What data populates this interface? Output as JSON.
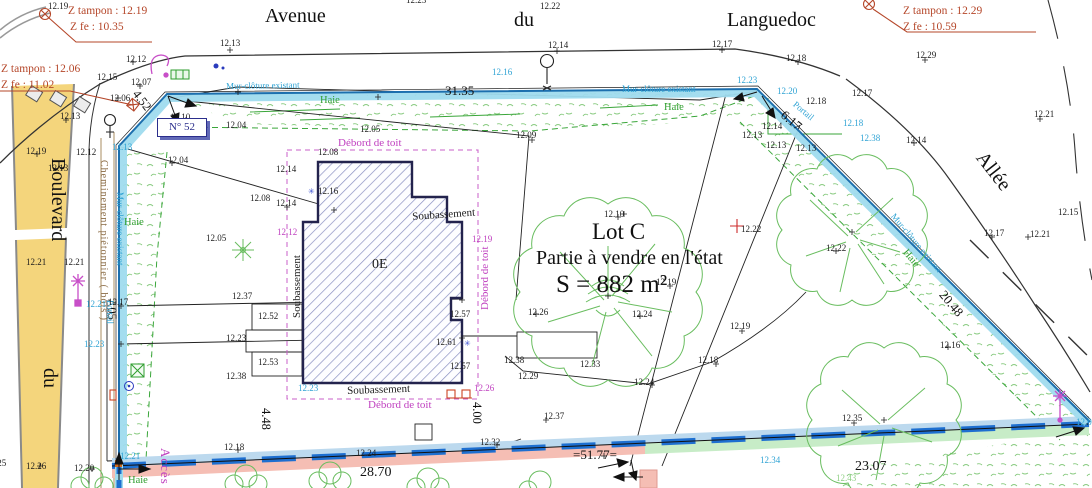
{
  "plate": {
    "text": "N° 52"
  },
  "colors": {
    "wall_band": "#9fdbee",
    "wall_line": "#1c6fae",
    "boundary_dash": "#1e6fd0",
    "hedge_green": "#2f9e2f",
    "speckle": "#86c97d",
    "magenta": "#bf3fbf",
    "red_note": "#b5472a",
    "cyan_label": "#2fa3d4",
    "road_yellow": "#f4d57c",
    "pink_band": "#f5beb4",
    "green_band": "#c7ecc7",
    "blue_band": "#bcd9ee",
    "hatch": "#8a90c2"
  },
  "labels": [
    {
      "t": "Avenue",
      "x": 265,
      "y": 6,
      "c": "s"
    },
    {
      "t": "du",
      "x": 514,
      "y": 10,
      "c": "s"
    },
    {
      "t": "Languedoc",
      "x": 727,
      "y": 10,
      "c": "s"
    },
    {
      "t": "Boulevard",
      "x": 68,
      "y": 158,
      "c": "s",
      "r": 90
    },
    {
      "t": "du",
      "x": 60,
      "y": 368,
      "c": "s",
      "r": 90
    },
    {
      "t": "Allée",
      "x": 988,
      "y": 148,
      "c": "s",
      "r": 52
    },
    {
      "t": "Accès à",
      "x": 172,
      "y": 448,
      "c": "ma",
      "r": 90
    },
    {
      "t": "Z tampon : 12.19",
      "x": 68,
      "y": 6,
      "c": "r"
    },
    {
      "t": "Z fe : 10.35",
      "x": 70,
      "y": 22,
      "c": "r"
    },
    {
      "t": "Z tampon : 12.06",
      "x": 1,
      "y": 64,
      "c": "r"
    },
    {
      "t": "Z fe : 11.02",
      "x": 1,
      "y": 80,
      "c": "r"
    },
    {
      "t": "Z tampon : 12.29",
      "x": 903,
      "y": 6,
      "c": "r"
    },
    {
      "t": "Z fe : 10.59",
      "x": 903,
      "y": 22,
      "c": "r"
    },
    {
      "t": "31.35",
      "x": 445,
      "y": 84,
      "c": "d",
      "s": 13
    },
    {
      "t": "4.52",
      "x": 140,
      "y": 88,
      "c": "d",
      "r": 52
    },
    {
      "t": "6.17",
      "x": 787,
      "y": 108,
      "c": "d",
      "r": 40,
      "s": 13
    },
    {
      "t": "20.48",
      "x": 947,
      "y": 288,
      "c": "d",
      "r": 50,
      "s": 13
    },
    {
      "t": "7.05",
      "x": 118,
      "y": 298,
      "c": "d",
      "r": 90
    },
    {
      "t": "4.48",
      "x": 272,
      "y": 408,
      "c": "d",
      "r": 90
    },
    {
      "t": "4.00",
      "x": 483,
      "y": 402,
      "c": "d",
      "r": 90
    },
    {
      "t": "28.70",
      "x": 360,
      "y": 466,
      "c": "d",
      "s": 14
    },
    {
      "t": "=51.77=",
      "x": 573,
      "y": 448,
      "c": "d",
      "s": 13
    },
    {
      "t": "23.07",
      "x": 855,
      "y": 460,
      "c": "d",
      "s": 14
    },
    {
      "t": "Lot C",
      "x": 592,
      "y": 220,
      "c": "l1"
    },
    {
      "t": "Partie à vendre en l'état",
      "x": 536,
      "y": 248,
      "c": "l2"
    },
    {
      "t": "S = 882 m²",
      "x": 556,
      "y": 272,
      "c": "l3"
    },
    {
      "t": "0E",
      "x": 372,
      "y": 258,
      "c": "e",
      "s": 14
    },
    {
      "t": "Soubassement",
      "x": 292,
      "y": 318,
      "c": "e",
      "s": 11,
      "r": -90
    },
    {
      "t": "Soubassement",
      "x": 412,
      "y": 212,
      "c": "e",
      "s": 11,
      "r": -4
    },
    {
      "t": "Soubassement",
      "x": 347,
      "y": 386,
      "c": "e",
      "s": 11,
      "r": -2
    },
    {
      "t": "Débord de toit",
      "x": 338,
      "y": 138,
      "c": "m",
      "s": 11
    },
    {
      "t": "Débord de toit",
      "x": 480,
      "y": 310,
      "c": "m",
      "s": 11,
      "r": -90
    },
    {
      "t": "Débord de toit",
      "x": 368,
      "y": 400,
      "c": "m",
      "s": 11
    },
    {
      "t": "Mur-clôture existant",
      "x": 226,
      "y": 82,
      "c": "c",
      "r": -1
    },
    {
      "t": "Mur-clôture existant",
      "x": 622,
      "y": 85,
      "c": "c"
    },
    {
      "t": "Mur-clôture existant",
      "x": 124,
      "y": 192,
      "c": "c",
      "r": 90
    },
    {
      "t": "Mur-clôture existant",
      "x": 896,
      "y": 212,
      "c": "c",
      "r": 50
    },
    {
      "t": "Portail",
      "x": 114,
      "y": 300,
      "c": "c",
      "r": 90
    },
    {
      "t": "Portail",
      "x": 797,
      "y": 100,
      "c": "c",
      "r": 40
    },
    {
      "t": "Cheminement piétonnier ( bois )",
      "x": 108,
      "y": 160,
      "c": "b",
      "r": 90
    },
    {
      "t": "Haie",
      "x": 320,
      "y": 96,
      "c": "g"
    },
    {
      "t": "Haie",
      "x": 664,
      "y": 103,
      "c": "g"
    },
    {
      "t": "Haie",
      "x": 124,
      "y": 218,
      "c": "g"
    },
    {
      "t": "Haie",
      "x": 908,
      "y": 248,
      "c": "g",
      "r": 50
    },
    {
      "t": "Haie",
      "x": 128,
      "y": 476,
      "c": "g"
    },
    {
      "t": "12.43",
      "x": 836,
      "y": 474,
      "c": "gl"
    },
    {
      "t": "12.16",
      "x": 492,
      "y": 68,
      "c": "c"
    },
    {
      "t": "12.23",
      "x": 737,
      "y": 76,
      "c": "c"
    },
    {
      "t": "12.20",
      "x": 777,
      "y": 87,
      "c": "c"
    },
    {
      "t": "12.18",
      "x": 843,
      "y": 119,
      "c": "c"
    },
    {
      "t": "12.38",
      "x": 860,
      "y": 134,
      "c": "c"
    },
    {
      "t": "12.13",
      "x": 112,
      "y": 143,
      "c": "c"
    },
    {
      "t": "12.21",
      "x": 86,
      "y": 300,
      "c": "c"
    },
    {
      "t": "12.23",
      "x": 84,
      "y": 340,
      "c": "c"
    },
    {
      "t": "12.21",
      "x": 120,
      "y": 452,
      "c": "c"
    },
    {
      "t": "12.34",
      "x": 760,
      "y": 456,
      "c": "c"
    },
    {
      "t": "12.0",
      "x": 1076,
      "y": 418,
      "c": "c"
    },
    {
      "t": "12.23",
      "x": 298,
      "y": 384,
      "c": "c"
    },
    {
      "t": "12.12",
      "x": 277,
      "y": 228,
      "c": "m"
    },
    {
      "t": "12.19",
      "x": 472,
      "y": 235,
      "c": "m"
    },
    {
      "t": "12.26",
      "x": 474,
      "y": 384,
      "c": "m"
    },
    {
      "t": "✳",
      "x": 308,
      "y": 188,
      "c": "u"
    },
    {
      "t": "✳",
      "x": 464,
      "y": 340,
      "c": "u"
    },
    {
      "t": "12.19",
      "x": 48,
      "y": 2,
      "c": "e"
    },
    {
      "t": "12.23",
      "x": 406,
      "y": -4,
      "c": "e"
    },
    {
      "t": "12.22",
      "x": 540,
      "y": 2,
      "c": "e"
    },
    {
      "t": "12.13",
      "x": 220,
      "y": 39,
      "c": "e"
    },
    {
      "t": "12.14",
      "x": 548,
      "y": 41,
      "c": "e"
    },
    {
      "t": "12.17",
      "x": 712,
      "y": 40,
      "c": "e"
    },
    {
      "t": "12.18",
      "x": 786,
      "y": 54,
      "c": "e"
    },
    {
      "t": "12.29",
      "x": 916,
      "y": 51,
      "c": "e"
    },
    {
      "t": "12.12",
      "x": 126,
      "y": 55,
      "c": "e"
    },
    {
      "t": "12.15",
      "x": 97,
      "y": 73,
      "c": "e"
    },
    {
      "t": "12.07",
      "x": 131,
      "y": 78,
      "c": "e"
    },
    {
      "t": "12.06",
      "x": 110,
      "y": 94,
      "c": "e"
    },
    {
      "t": "12.13",
      "x": 60,
      "y": 112,
      "c": "e"
    },
    {
      "t": "12.19",
      "x": 26,
      "y": 147,
      "c": "e"
    },
    {
      "t": "12.13",
      "x": 48,
      "y": 164,
      "c": "e"
    },
    {
      "t": "12.12",
      "x": 76,
      "y": 148,
      "c": "e"
    },
    {
      "t": "12.10",
      "x": 170,
      "y": 113,
      "c": "e"
    },
    {
      "t": "12.04",
      "x": 226,
      "y": 121,
      "c": "e"
    },
    {
      "t": "12.05",
      "x": 360,
      "y": 125,
      "c": "e"
    },
    {
      "t": "12.09",
      "x": 516,
      "y": 131,
      "c": "e"
    },
    {
      "t": "12.04",
      "x": 168,
      "y": 156,
      "c": "e"
    },
    {
      "t": "12.14",
      "x": 276,
      "y": 165,
      "c": "e"
    },
    {
      "t": "12.16",
      "x": 318,
      "y": 187,
      "c": "e"
    },
    {
      "t": "12.08",
      "x": 250,
      "y": 194,
      "c": "e"
    },
    {
      "t": "12.14",
      "x": 276,
      "y": 199,
      "c": "e"
    },
    {
      "t": "12.08",
      "x": 318,
      "y": 148,
      "c": "e"
    },
    {
      "t": "12.05",
      "x": 206,
      "y": 234,
      "c": "e"
    },
    {
      "t": "12.10",
      "x": 604,
      "y": 210,
      "c": "e"
    },
    {
      "t": "12.22",
      "x": 741,
      "y": 225,
      "c": "e"
    },
    {
      "t": "12.22",
      "x": 826,
      "y": 244,
      "c": "e"
    },
    {
      "t": "12.19",
      "x": 656,
      "y": 278,
      "c": "e"
    },
    {
      "t": "12.19",
      "x": 730,
      "y": 322,
      "c": "e"
    },
    {
      "t": "12.21",
      "x": 1034,
      "y": 110,
      "c": "e"
    },
    {
      "t": "12.15",
      "x": 1058,
      "y": 208,
      "c": "e"
    },
    {
      "t": "12.21",
      "x": 1030,
      "y": 230,
      "c": "e"
    },
    {
      "t": "12.17",
      "x": 984,
      "y": 229,
      "c": "e"
    },
    {
      "t": "12.14",
      "x": 906,
      "y": 136,
      "c": "e"
    },
    {
      "t": "12.13",
      "x": 742,
      "y": 131,
      "c": "e"
    },
    {
      "t": "12.14",
      "x": 762,
      "y": 122,
      "c": "e"
    },
    {
      "t": "12.13",
      "x": 766,
      "y": 141,
      "c": "e"
    },
    {
      "t": "12.13",
      "x": 796,
      "y": 144,
      "c": "e"
    },
    {
      "t": "12.18",
      "x": 806,
      "y": 97,
      "c": "e"
    },
    {
      "t": "12.17",
      "x": 852,
      "y": 89,
      "c": "e"
    },
    {
      "t": "12.21",
      "x": 26,
      "y": 258,
      "c": "e"
    },
    {
      "t": "12.21",
      "x": 64,
      "y": 258,
      "c": "e"
    },
    {
      "t": "12.17",
      "x": 108,
      "y": 298,
      "c": "e"
    },
    {
      "t": "12.37",
      "x": 232,
      "y": 292,
      "c": "e"
    },
    {
      "t": "12.52",
      "x": 258,
      "y": 312,
      "c": "e"
    },
    {
      "t": "12.23",
      "x": 226,
      "y": 334,
      "c": "e"
    },
    {
      "t": "12.53",
      "x": 258,
      "y": 358,
      "c": "e"
    },
    {
      "t": "12.38",
      "x": 226,
      "y": 372,
      "c": "e"
    },
    {
      "t": "12.61",
      "x": 436,
      "y": 338,
      "c": "e"
    },
    {
      "t": "12.57",
      "x": 450,
      "y": 310,
      "c": "e"
    },
    {
      "t": "12.57",
      "x": 450,
      "y": 362,
      "c": "e"
    },
    {
      "t": "12.29",
      "x": 518,
      "y": 372,
      "c": "e"
    },
    {
      "t": "12.38",
      "x": 504,
      "y": 356,
      "c": "e"
    },
    {
      "t": "12.33",
      "x": 580,
      "y": 360,
      "c": "e"
    },
    {
      "t": "12.37",
      "x": 544,
      "y": 412,
      "c": "e"
    },
    {
      "t": "12.24",
      "x": 634,
      "y": 378,
      "c": "e"
    },
    {
      "t": "12.18",
      "x": 698,
      "y": 356,
      "c": "e"
    },
    {
      "t": "12.26",
      "x": 528,
      "y": 308,
      "c": "e"
    },
    {
      "t": "12.24",
      "x": 632,
      "y": 310,
      "c": "e"
    },
    {
      "t": "12.24",
      "x": 356,
      "y": 449,
      "c": "e"
    },
    {
      "t": "12.32",
      "x": 480,
      "y": 438,
      "c": "e"
    },
    {
      "t": "12.18",
      "x": 224,
      "y": 443,
      "c": "e"
    },
    {
      "t": "12.35",
      "x": 842,
      "y": 414,
      "c": "e"
    },
    {
      "t": "12.16",
      "x": 940,
      "y": 341,
      "c": "e"
    },
    {
      "t": "12.25",
      "x": -14,
      "y": 459,
      "c": "e"
    },
    {
      "t": "12.26",
      "x": 26,
      "y": 462,
      "c": "e"
    },
    {
      "t": "12.20",
      "x": 74,
      "y": 464,
      "c": "e"
    }
  ]
}
